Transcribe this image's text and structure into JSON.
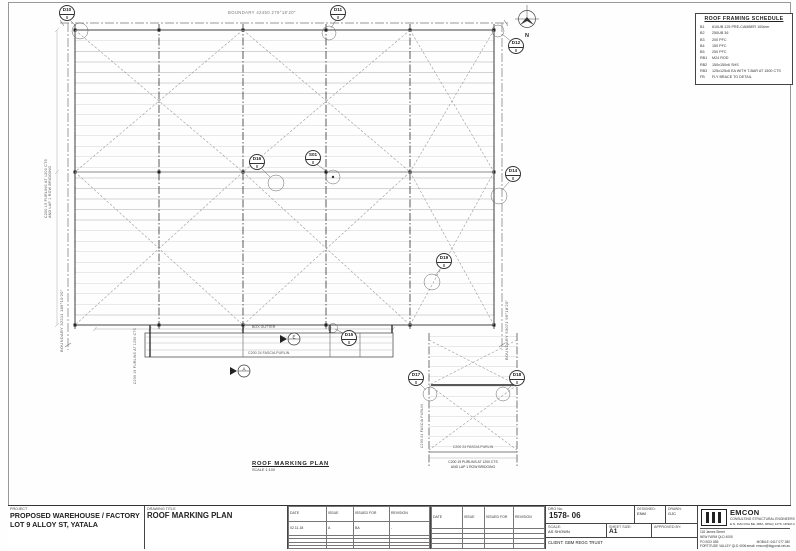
{
  "sheet": {
    "plan_title": "ROOF MARKING PLAN",
    "plan_scale": "SCALE 1:100"
  },
  "north_label": "N",
  "boundaries": {
    "top": "BOUNDARY 42450 279°18'20\"",
    "left": "BOUNDARY 32211 189°10'20\"",
    "right": "BOUNDARY 53071 99°18'20\""
  },
  "notes": {
    "left_purlin_note1": "C200 19 PURLINS AT 1200 CTS",
    "left_purlin_note2": "AND LAP 1 ROW BRIDGING",
    "strip_purlin_note": "C200 19 PURLINS AT 1200 CTS",
    "box_gutter": "BOX GUTTER",
    "fascia_purlin_mid": "C200 24 FASCIA PURLIN",
    "canopy_fascia_left": "C200 24 FASCIA PURLIN",
    "canopy_fascia_bottom": "C200 24 FASCIA PURLIN",
    "canopy_purlin_note1": "C200 19 PURLINS AT 1200 CTS",
    "canopy_purlin_note2": "AND LAP 1 ROW BRIDGING"
  },
  "sections": {
    "a": "A",
    "e": "E"
  },
  "callouts": {
    "c1": {
      "top": "D10",
      "bottom": "8"
    },
    "c2": {
      "top": "D11",
      "bottom": "8"
    },
    "c3": {
      "top": "D12",
      "bottom": "8"
    },
    "c4": {
      "top": "D16",
      "bottom": "8"
    },
    "c5": {
      "top": "S01",
      "bottom": "8"
    },
    "c6": {
      "top": "D19",
      "bottom": "8"
    },
    "c7": {
      "top": "D15",
      "bottom": "8"
    },
    "c8": {
      "top": "D17",
      "bottom": "8"
    },
    "c9": {
      "top": "D18",
      "bottom": "8"
    },
    "c10": {
      "top": "D14",
      "bottom": "8"
    }
  },
  "schedule": {
    "title": "ROOF FRAMING SCHEDULE",
    "rows": [
      {
        "tag": "B1",
        "desc": "610UB 125 PRE-CAMBER 100mm"
      },
      {
        "tag": "B2",
        "desc": "250UB 36"
      },
      {
        "tag": "B3",
        "desc": "200 PFC"
      },
      {
        "tag": "B4",
        "desc": "150 PFC"
      },
      {
        "tag": "B5",
        "desc": "250 PFC"
      },
      {
        "tag": "RB1",
        "desc": "M24 ROD"
      },
      {
        "tag": "RB2",
        "desc": "150x150x6 SHS"
      },
      {
        "tag": "RB3",
        "desc": "125x125x6 EA WITH T-BAR AT 1500 CTS"
      },
      {
        "tag": "FB",
        "desc": "FLY BRACE TO DETAIL"
      }
    ]
  },
  "titleblock": {
    "project_label": "PROJECT",
    "project_line1": "PROPOSED WAREHOUSE / FACTORY",
    "project_line2": "LOT 9 ALLOY ST, YATALA",
    "drawing_title_label": "DRAWING TITLE",
    "drawing_title": "ROOF MARKING PLAN",
    "rev_headers": {
      "date": "DATE",
      "issue": "ISSUE",
      "issued_for": "ISSUED FOR",
      "revision": "REVISION"
    },
    "rev_row": {
      "date": "02.11.18",
      "issue": "A",
      "issued_for": "BA",
      "revision": "-"
    },
    "drg_label": "DRG No.",
    "drg_no": "1578- 06",
    "designed_label": "DESIGNED:",
    "designed": "ENM",
    "drawn_label": "DRAWN:",
    "drawn": "GJC",
    "scale_label": "SCALE:",
    "scale": "AS SHOWN",
    "sheet_size_label": "SHEET SIZE:",
    "sheet_size": "A1",
    "approved_label": "APPROVED BY:",
    "client": "CLIENT: GBM REGG TRUST",
    "firm": {
      "name": "EMCON",
      "tagline": "CONSULTING STRUCTURAL ENGINEERS",
      "credentials": "E.N. MACUSA BE, MBA, RPEQ 1378, NPER-3",
      "address1": "118 James Street",
      "address2": "NEW FARM QLD 4005",
      "address3": "PO BOX 855",
      "address4": "FORTITUDE VALLEY QLD 4006",
      "mobile": "MOBILE: 0417 077 380",
      "email": "email: emcon@bigpond.net.au"
    }
  }
}
